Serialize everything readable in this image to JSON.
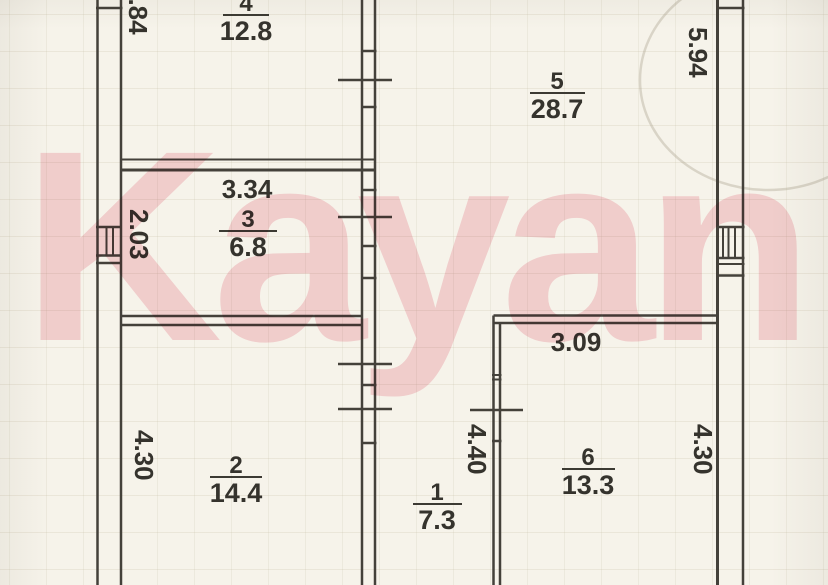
{
  "watermark": {
    "text": "Kayan",
    "color": "#f9d7de"
  },
  "plan": {
    "paper_color": "#f6f3ea",
    "line_color": "#44413a",
    "rooms": [
      {
        "number": "4",
        "area": "12.8"
      },
      {
        "number": "5",
        "area": "28.7"
      },
      {
        "number": "3",
        "area": "6.8"
      },
      {
        "number": "2",
        "area": "14.4"
      },
      {
        "number": "1",
        "area": "7.3"
      },
      {
        "number": "6",
        "area": "13.3"
      }
    ],
    "dimensions": {
      "left_wall_top": "3.84",
      "right_wall_top": "5.94",
      "room3_width": "3.34",
      "room3_height": "2.03",
      "room2_height": "4.30",
      "room1_height": "4.40",
      "room6_width": "3.09",
      "room6_height": "4.30"
    }
  }
}
